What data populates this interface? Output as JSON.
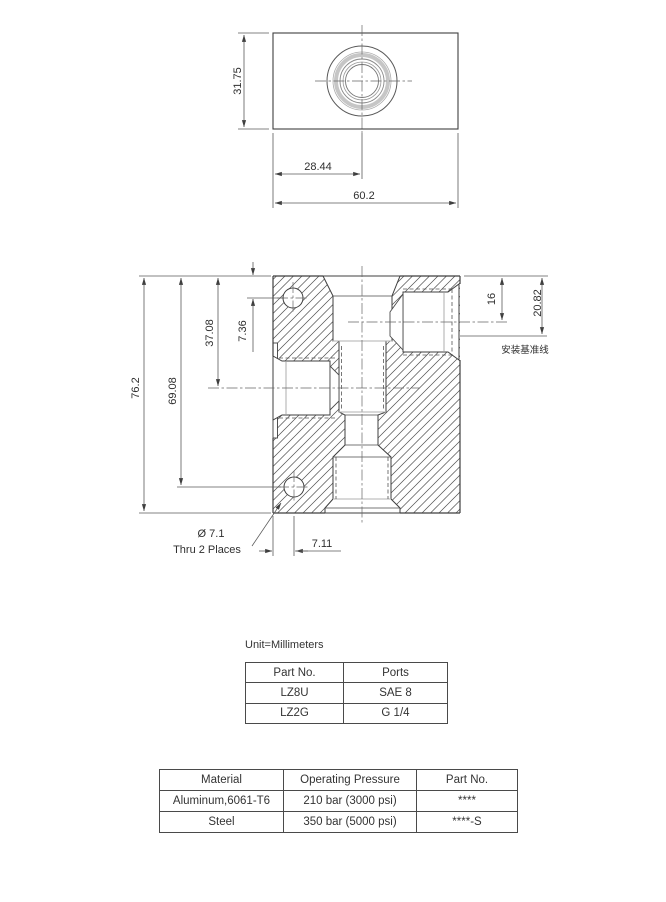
{
  "unit_note": "Unit=Millimeters",
  "top_view": {
    "dims": {
      "depth": "31.75",
      "port_center_x": "28.44",
      "width": "60.2"
    }
  },
  "front_view": {
    "dims": {
      "overall_height": "76.2",
      "lower_hole_y": "69.08",
      "left_port_y": "37.08",
      "upper_hole_y": "7.36",
      "right_port_y": "16",
      "datum_y": "20.82",
      "hole_offset_x": "7.11"
    },
    "datum_label": "安装基准线",
    "hole_callout": {
      "diameter": "Ø 7.1",
      "note": "Thru 2 Places"
    }
  },
  "ports_table": {
    "headers": [
      "Part No.",
      "Ports"
    ],
    "rows": [
      [
        "LZ8U",
        "SAE 8"
      ],
      [
        "LZ2G",
        "G 1/4"
      ]
    ]
  },
  "specs_table": {
    "headers": [
      "Material",
      "Operating Pressure",
      "Part No."
    ],
    "rows": [
      [
        "Aluminum,6061-T6",
        "210 bar (3000 psi)",
        "****"
      ],
      [
        "Steel",
        "350 bar (5000 psi)",
        "****-S"
      ]
    ]
  },
  "colors": {
    "line": "#3f3f3f",
    "thin_line": "#5a5a5a",
    "hatch": "#4d4d4d",
    "thread_gray": "#c6c6c6",
    "text": "#2f2f2f"
  }
}
